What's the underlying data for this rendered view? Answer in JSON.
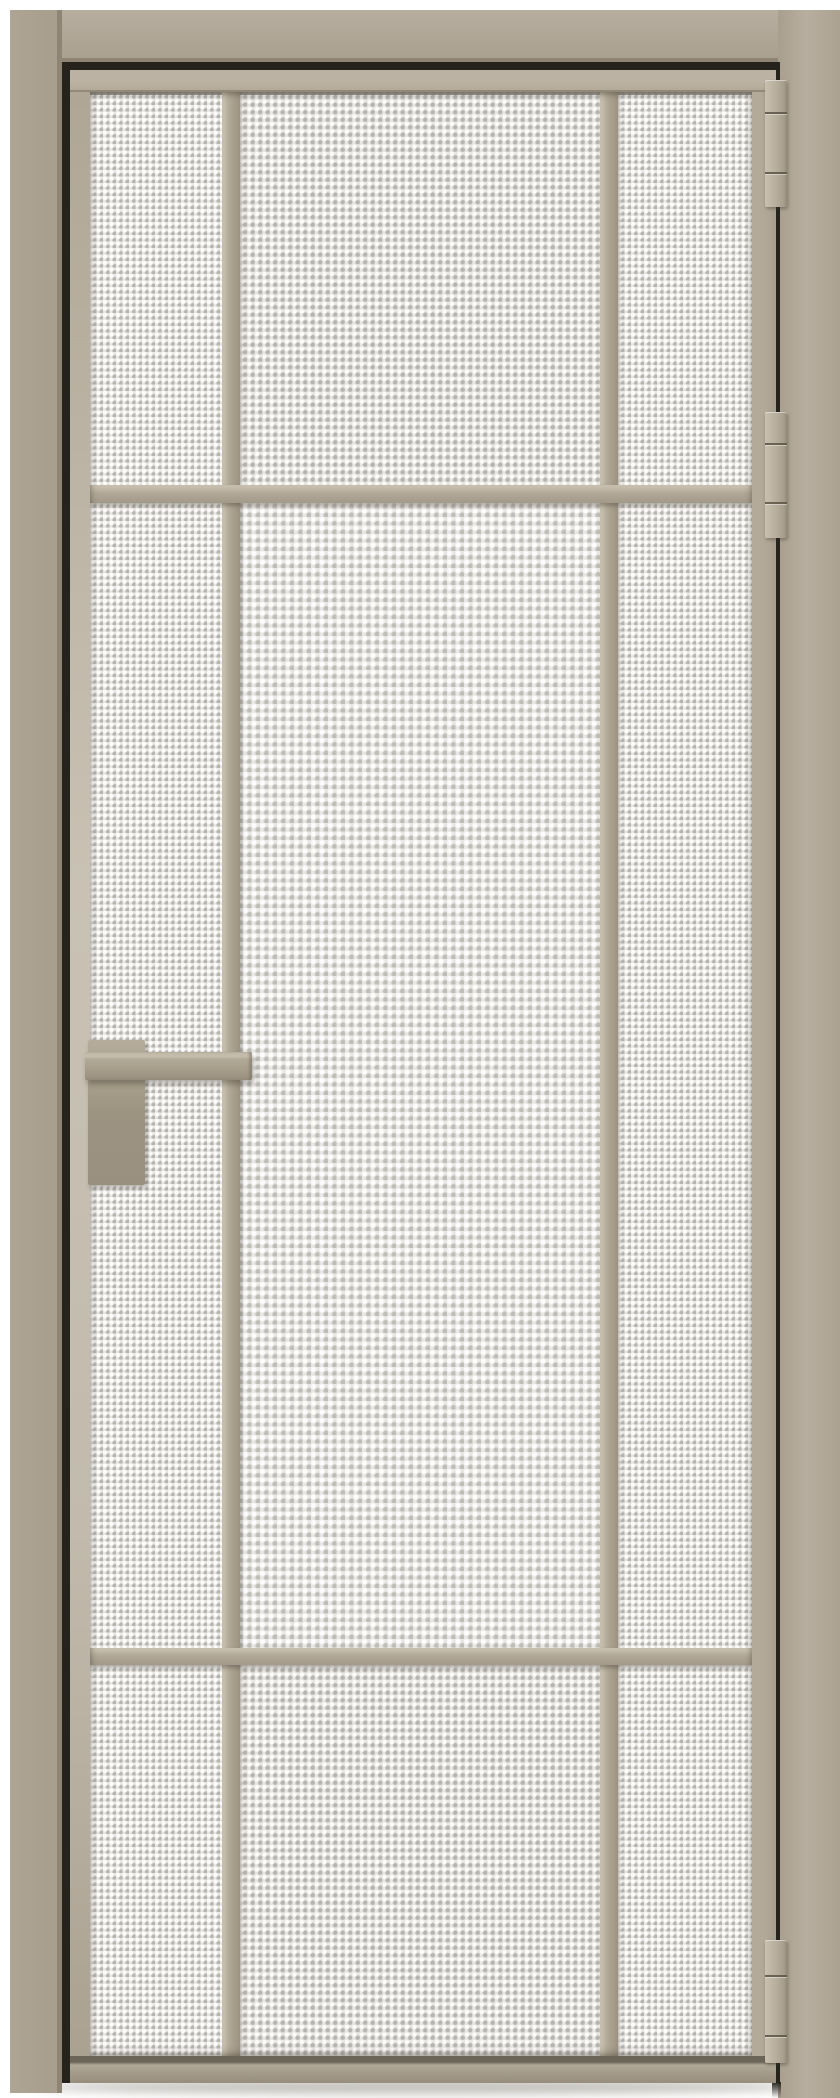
{
  "image": {
    "kind": "product-photo",
    "description": "Interior hinged door with matte taupe aluminum frame and textured privacy glass, shown closed in a white wall opening on a white floor"
  },
  "palette": {
    "background": "#ffffff",
    "casing": "#a89f8e",
    "casing_light": "#b7aea0",
    "casing_dark": "#8e8574",
    "profile": "#b2a896",
    "profile_light": "#c6bead",
    "profile_dark": "#9c9280",
    "stile_light": "#c9c2b4",
    "rail_shadow": "#6b6557",
    "handle": "#a89e8c",
    "handle_light": "#c4bcab",
    "hinge": "#b7ae9d",
    "hinge_light": "#c9c0b0",
    "hinge_dark": "#948a79",
    "glass": "#e9e7e4",
    "glass_dot": "#b3b0aa",
    "reveal": "#26231c"
  },
  "door": {
    "swing": "right-hinged",
    "hinges": {
      "count": 3,
      "side": "right",
      "style": "segmented barrel"
    },
    "handle": {
      "side": "left",
      "style": "square lever on rectangular backplate"
    },
    "glass": {
      "finish": "textured waffle pattern",
      "columns": 3,
      "rows": 3
    },
    "grid": {
      "vertical_muntins": 2,
      "horizontal_muntins": 2
    },
    "frame": {
      "material": "aluminum",
      "finish": "matte taupe"
    }
  }
}
